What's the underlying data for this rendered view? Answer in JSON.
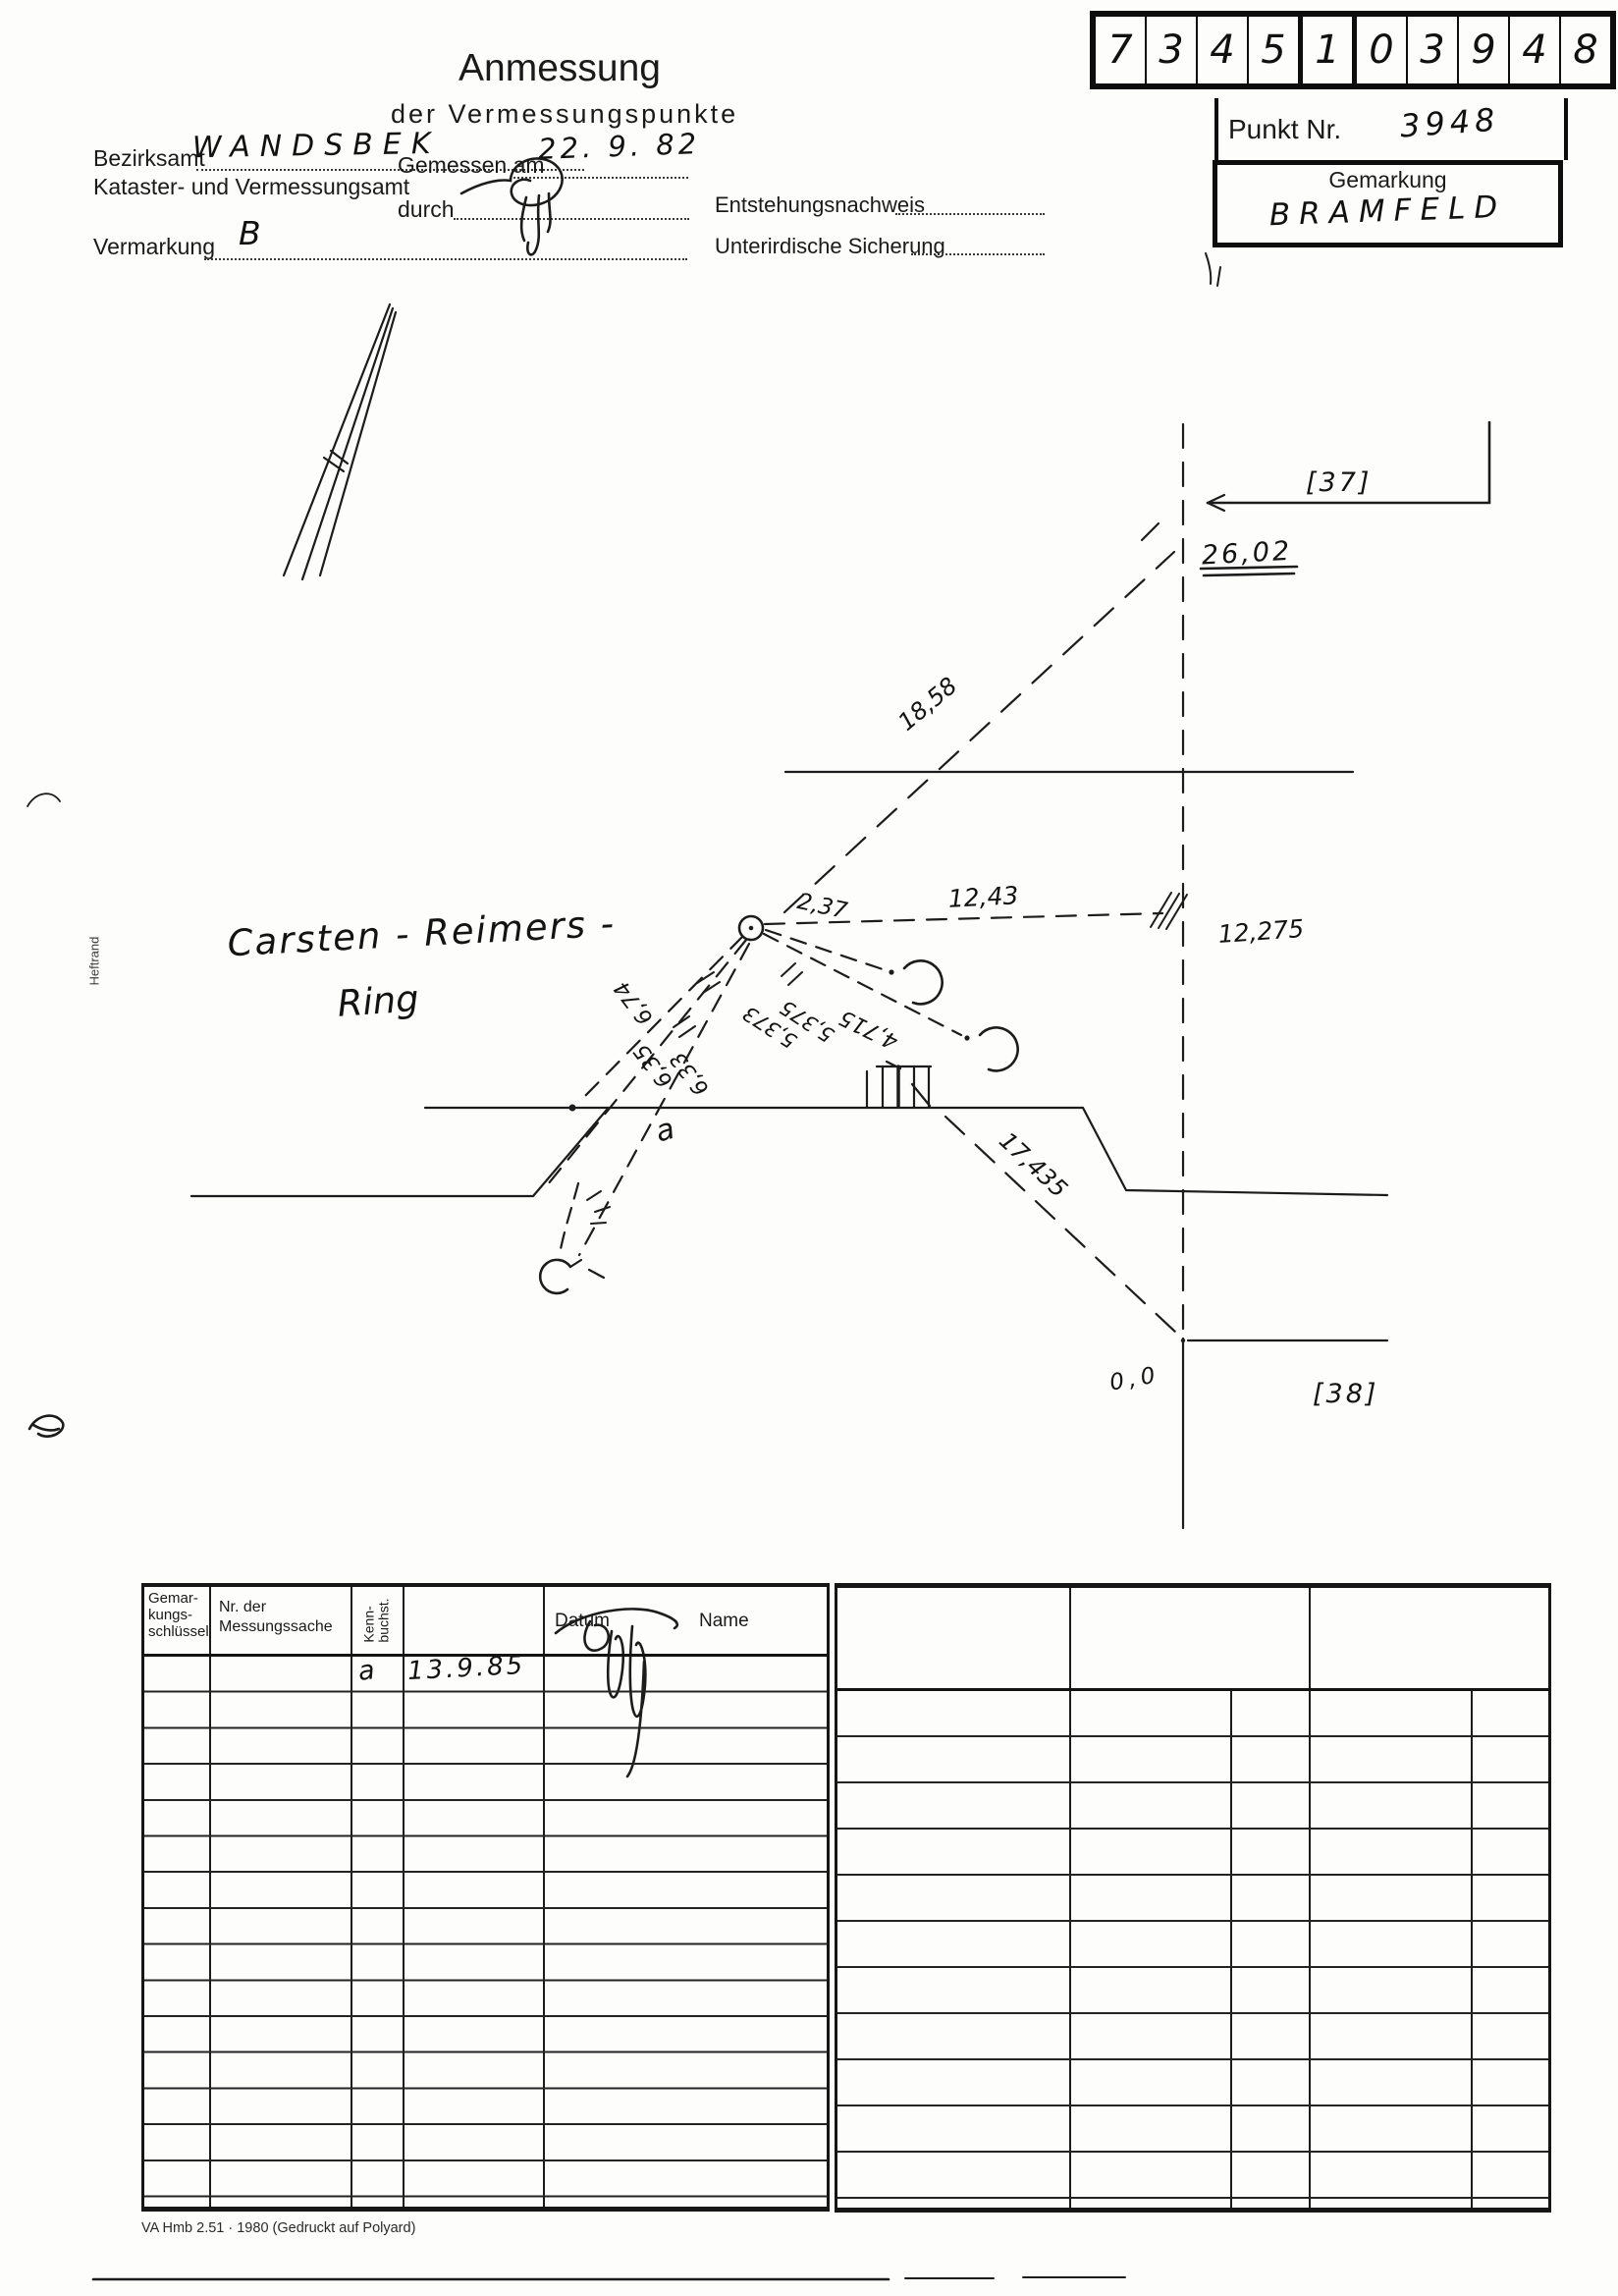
{
  "scan": {
    "id_boxes": {
      "digits": [
        "7",
        "3",
        "4",
        "5",
        "1",
        "0",
        "3",
        "9",
        "4",
        "8"
      ]
    },
    "point_box": {
      "label": "Punkt Nr.",
      "value": "3948",
      "gemarkung_label": "Gemarkung",
      "gemarkung_value": "BRAMFELD"
    },
    "title": "Anmessung",
    "subtitle": "der Vermessungspunkte",
    "fields": {
      "bezirksamt_label": "Bezirksamt",
      "bezirksamt_value": "WANDSBEK",
      "kataster_label": "Kataster- und Vermessungsamt",
      "gemessen_label": "Gemessen am",
      "gemessen_value": "22. 9. 82",
      "durch_label": "durch",
      "vermarkung_label": "Vermarkung",
      "vermarkung_value": "B",
      "entstehung_label": "Entstehungsnachweis",
      "sicherung_label": "Unterirdische Sicherung"
    },
    "margin_label": "Heftrand",
    "sketch": {
      "street_line1": "Carsten - Reimers -",
      "street_line2": "Ring",
      "ref_top": "[37]",
      "ref_bottom": "[38]",
      "m_26_02": "26,02",
      "m_18_58": "18,58",
      "m_12_43": "12,43",
      "m_12_275": "12,275",
      "m_2_37": "2,37",
      "m_4_715": "4,715",
      "m_5_373": "5,373",
      "m_5_375": "5,375",
      "m_6_74": "6,74",
      "m_6_35": "6,35",
      "m_6_33": "6,33",
      "m_17_435": "17,435",
      "m_0_0": "0,0",
      "letter_a": "a"
    },
    "table": {
      "col1_line1": "Gemar-",
      "col1_line2": "kungs-",
      "col1_line3": "schlüssel",
      "col2_line1": "Nr. der",
      "col2_line2": "Messungssache",
      "col3_line1": "Kenn-",
      "col3_line2": "buchst.",
      "col4": "Datum",
      "col5": "Name",
      "row1_kennbuchst": "a",
      "row1_datum": "13.9.85"
    },
    "footer": "VA Hmb 2.51 · 1980 (Gedruckt auf Polyard)"
  }
}
